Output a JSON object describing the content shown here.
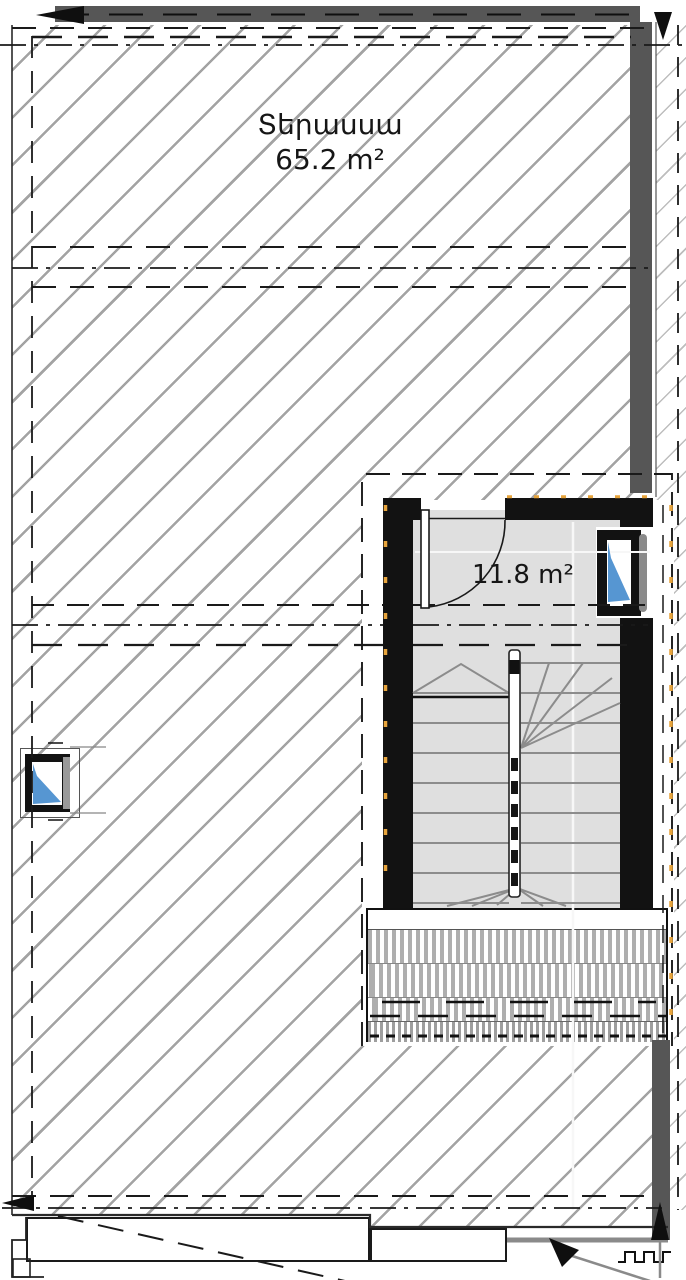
{
  "drawing": {
    "rooms": {
      "terrace": {
        "name": "Տերասսա",
        "area": "65.2 m²"
      },
      "stairwell": {
        "area": "11.8 m²"
      }
    },
    "colors": {
      "wall_black": "#121212",
      "concrete_gray": "#565656",
      "floor_gray": "#dfdfdf",
      "hatch_gray": "#a3a3a3",
      "glazing_blue": "#5696d2",
      "insulation_orange": "#e7a43c",
      "slat_gray": "#aeaeae"
    }
  }
}
